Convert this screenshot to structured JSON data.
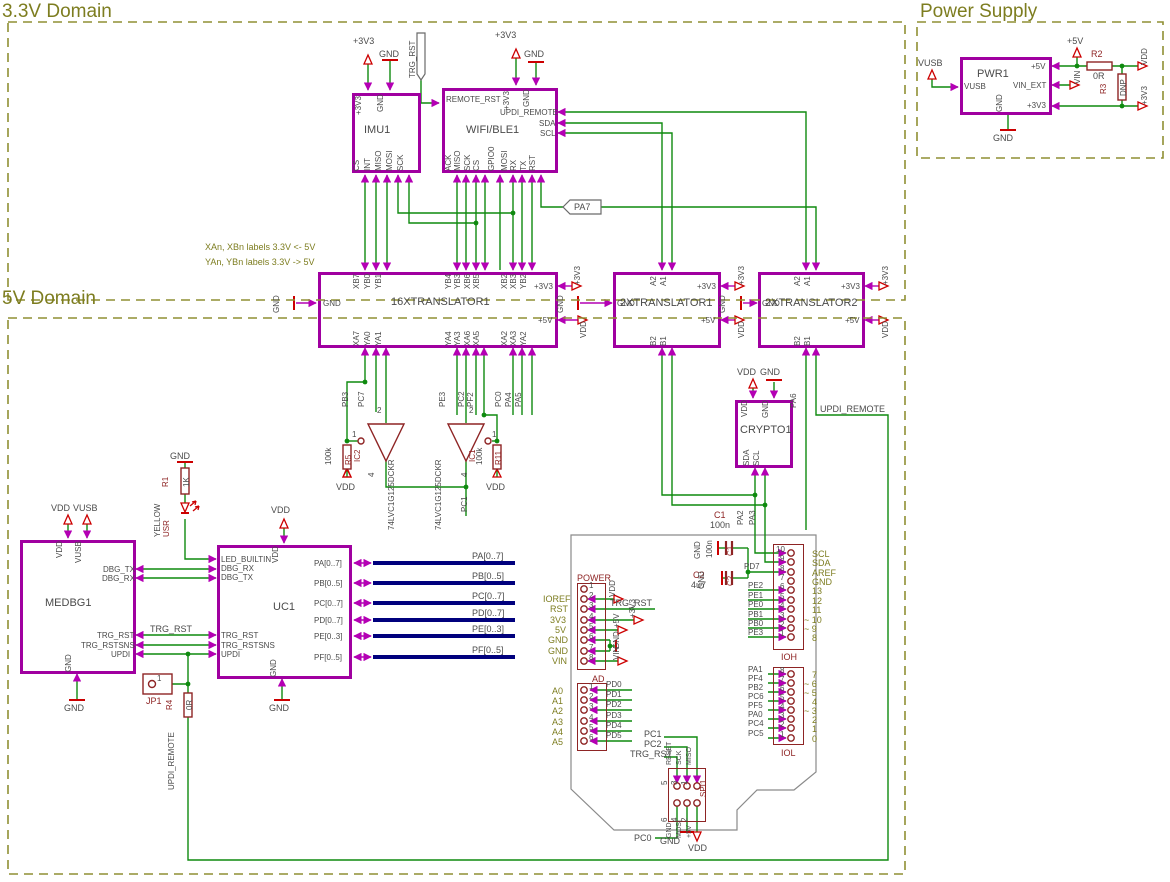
{
  "titles": {
    "d33": "3.3V Domain",
    "d5": "5V Domain",
    "psu": "Power Supply"
  },
  "notes": {
    "n1": "XAn, XBn labels 3.3V <- 5V",
    "n2": "YAn, YBn labels 3.3V -> 5V"
  },
  "power": {
    "p3v3": "+3V3",
    "p5v": "+5V",
    "gnd": "GND",
    "vdd": "VDD",
    "vin": "VIN",
    "vusb": "VUSB"
  },
  "nets": {
    "trg_rst": "TRG_RST",
    "pa7": "PA7",
    "updi_remote": "UPDI_REMOTE",
    "pb3": "PB3",
    "pc7": "PC7",
    "pc1": "PC1",
    "pe3": "PE3",
    "pc2": "PC2",
    "pf2": "PF2",
    "pc0": "PC0",
    "pa4": "PA4",
    "pa5": "PA5",
    "pa2": "PA2",
    "pa3": "PA3",
    "pa6": "PA6",
    "pd7": "PD7"
  },
  "imu": {
    "ref": "IMU1",
    "top": [
      "+3V3",
      "GND"
    ],
    "bottom": [
      "CS",
      "INT",
      "MISO",
      "MOSI",
      "SCK"
    ]
  },
  "wifi": {
    "ref": "WIFI/BLE1",
    "left": "REMOTE_RST",
    "top": [
      "+3V3",
      "GND"
    ],
    "right": [
      "UPDI_REMOTE",
      "SDA",
      "SCL"
    ],
    "bottom": [
      "ACK",
      "MISO",
      "SCK",
      "CS",
      "GPIO0",
      "MOSI",
      "RX",
      "TX",
      "RST"
    ]
  },
  "t16": {
    "ref": "16XTRANSLATOR1",
    "gnd": "GND",
    "p3v3": "+3V3",
    "p5v": "+5V",
    "top": [
      "XB7",
      "YB0",
      "YB1",
      "YB4",
      "YB3",
      "XB6",
      "XB5",
      "XB2",
      "XB3",
      "YB2"
    ],
    "bottom": [
      "XA7",
      "YA0",
      "YA1",
      "YA4",
      "YA3",
      "XA6",
      "XA5",
      "XA2",
      "XA3",
      "YA2"
    ]
  },
  "t2a": {
    "ref": "2XTRANSLATOR1",
    "gnd": "GND",
    "p3v3": "+3V3",
    "p5v": "+5V",
    "top": [
      "A2",
      "A1"
    ],
    "bottom": [
      "B2",
      "B1"
    ]
  },
  "t2b": {
    "ref": "2XTRANSLATOR2",
    "gnd": "GND",
    "p3v3": "+3V3",
    "p5v": "+5V",
    "top": [
      "A2",
      "A1"
    ],
    "bottom": [
      "B2",
      "B1"
    ]
  },
  "crypto": {
    "ref": "CRYPTO1",
    "top": [
      "VDD",
      "GND"
    ],
    "bottom": [
      "SDA",
      "SCL"
    ]
  },
  "medbg": {
    "ref": "MEDBG1",
    "top": [
      "VDD",
      "VUSB"
    ],
    "right": [
      "DBG_TX",
      "DBG_RX",
      "TRG_RST",
      "TRG_RSTSNS",
      "UPDI"
    ],
    "gnd": "GND"
  },
  "uc": {
    "ref": "UC1",
    "left": [
      "LED_BUILTIN",
      "DBG_RX",
      "DBG_TX",
      "TRG_RST",
      "TRG_RSTSNS",
      "UPDI"
    ],
    "vdd": "VDD",
    "gnd": "GND",
    "right": [
      "PA[0..7]",
      "PB[0..5]",
      "PC[0..7]",
      "PD[0..7]",
      "PE[0..3]",
      "PF[0..5]"
    ]
  },
  "pwr": {
    "ref": "PWR1",
    "left": "VUSB",
    "right": [
      "+5V",
      "VIN_EXT",
      "+3V3"
    ],
    "gnd": "GND"
  },
  "ic1": {
    "ref": "IC1",
    "part": "74LVC1G125DCKR",
    "p1": "1",
    "p2": "2",
    "p4": "4"
  },
  "ic2": {
    "ref": "IC2",
    "part": "74LVC1G125DCKR",
    "p1": "1",
    "p2": "2",
    "p4": "4"
  },
  "r1": {
    "ref": "R1",
    "val": "1K"
  },
  "r2": {
    "ref": "R2",
    "val": "0R"
  },
  "r3": {
    "ref": "R3",
    "val": "DNP"
  },
  "r4": {
    "ref": "R4",
    "val": "0R"
  },
  "r5": {
    "ref": "R5",
    "val": "100k"
  },
  "r11": {
    "ref": "R11",
    "val": "100k"
  },
  "c1": {
    "ref": "C1",
    "val": "100n"
  },
  "c2": {
    "ref": "C2",
    "val": "4u7"
  },
  "led": {
    "ref": "USR",
    "color": "YELLOW"
  },
  "jp1": {
    "ref": "JP1",
    "pin": "1"
  },
  "hdr_power": {
    "ref": "POWER",
    "pins": [
      "1",
      "2",
      "3",
      "4",
      "5",
      "6",
      "7",
      "8"
    ],
    "ext": [
      "IOREF",
      "RST",
      "3V3",
      "5V",
      "GND",
      "GND",
      "VIN"
    ]
  },
  "hdr_ad": {
    "ref": "AD",
    "pins": [
      "1",
      "2",
      "3",
      "4",
      "5",
      "6"
    ],
    "ext": [
      "A0",
      "A1",
      "A2",
      "A3",
      "A4",
      "A5"
    ],
    "nets": [
      "PD0",
      "PD1",
      "PD2",
      "PD3",
      "PD4",
      "PD5"
    ]
  },
  "hdr_ioh": {
    "ref": "IOH",
    "pins": [
      "10",
      "9",
      "8",
      "7",
      "6",
      "5",
      "4",
      "3",
      "2",
      "1"
    ],
    "right": [
      "SCL",
      "SDA",
      "AREF",
      "GND",
      "13",
      "12",
      "11",
      "~ 10",
      "~ 9",
      "8"
    ],
    "left": [
      "PD7",
      "PE2",
      "PE1",
      "PE0",
      "PB1",
      "PB0",
      "PE3"
    ]
  },
  "hdr_iol": {
    "ref": "IOL",
    "pins": [
      "8",
      "7",
      "6",
      "5",
      "4",
      "3",
      "2",
      "1"
    ],
    "right": [
      "7",
      "~ 6",
      "~ 5",
      "4",
      "~ 3",
      "2",
      "1",
      "0"
    ],
    "left": [
      "PA1",
      "PF4",
      "PB2",
      "PC6",
      "PF5",
      "PA0",
      "PC4",
      "PC5"
    ]
  },
  "hdr_spi": {
    "ref": "SPI1",
    "top_pins": [
      "5",
      "3",
      "1"
    ],
    "bot_pins": [
      "6",
      "4",
      "2"
    ],
    "top_sigs": [
      "RESET",
      "SCK",
      "MISO"
    ],
    "bot_sigs": [
      "GND",
      "MOSI",
      "+5V"
    ]
  },
  "buses": {
    "a": "PA[0..7]",
    "b": "PB[0..5]",
    "c": "PC[0..7]",
    "d": "PD[0..7]",
    "e": "PE[0..3]",
    "f": "PF[0..5]"
  }
}
